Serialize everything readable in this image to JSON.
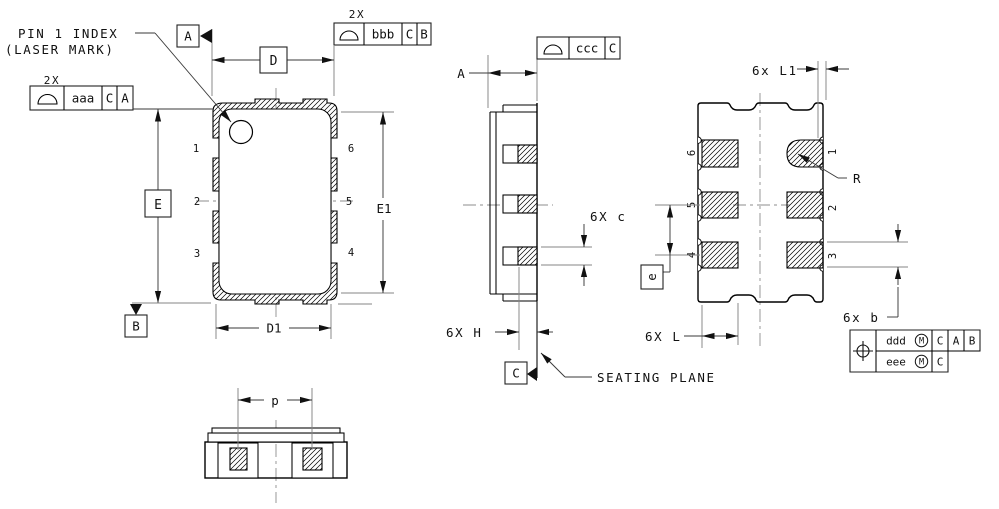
{
  "drawing": {
    "colors": {
      "background": "#ffffff",
      "object_line": "#000000",
      "dim_line": "#3a3a3a",
      "ext_line": "#858585"
    },
    "pin1_note": {
      "line1": "PIN 1 INDEX",
      "line2": "(LASER MARK)"
    },
    "seating_plane": "SEATING PLANE",
    "qty": {
      "aaa": "2X",
      "bbb": "2X",
      "c": "6X c",
      "h": "6X H",
      "l": "6X L",
      "l1": "6x L1",
      "b": "6x b"
    },
    "dims": {
      "D": "D",
      "D1": "D1",
      "E": "E",
      "E1": "E1",
      "A": "A",
      "p": "p",
      "e": "e",
      "R": "R"
    },
    "datums": {
      "A": "A",
      "B": "B",
      "C": "C"
    },
    "fcf": {
      "aaa": {
        "tol": "aaa",
        "ref1": "C",
        "ref2": "A"
      },
      "bbb": {
        "tol": "bbb",
        "ref1": "C",
        "ref2": "B"
      },
      "ccc": {
        "tol": "ccc",
        "ref1": "C"
      },
      "position": {
        "row1": {
          "tol": "ddd",
          "mod": "M",
          "ref1": "C",
          "ref2": "A",
          "ref3": "B"
        },
        "row2": {
          "tol": "eee",
          "mod": "M",
          "ref1": "C"
        }
      }
    },
    "top_view_pins": {
      "p1": "1",
      "p2": "2",
      "p3": "3",
      "p4": "4",
      "p5": "5",
      "p6": "6"
    },
    "bottom_view_pins": {
      "p1": "1",
      "p2": "2",
      "p3": "3",
      "p4": "4",
      "p5": "5",
      "p6": "6"
    }
  }
}
